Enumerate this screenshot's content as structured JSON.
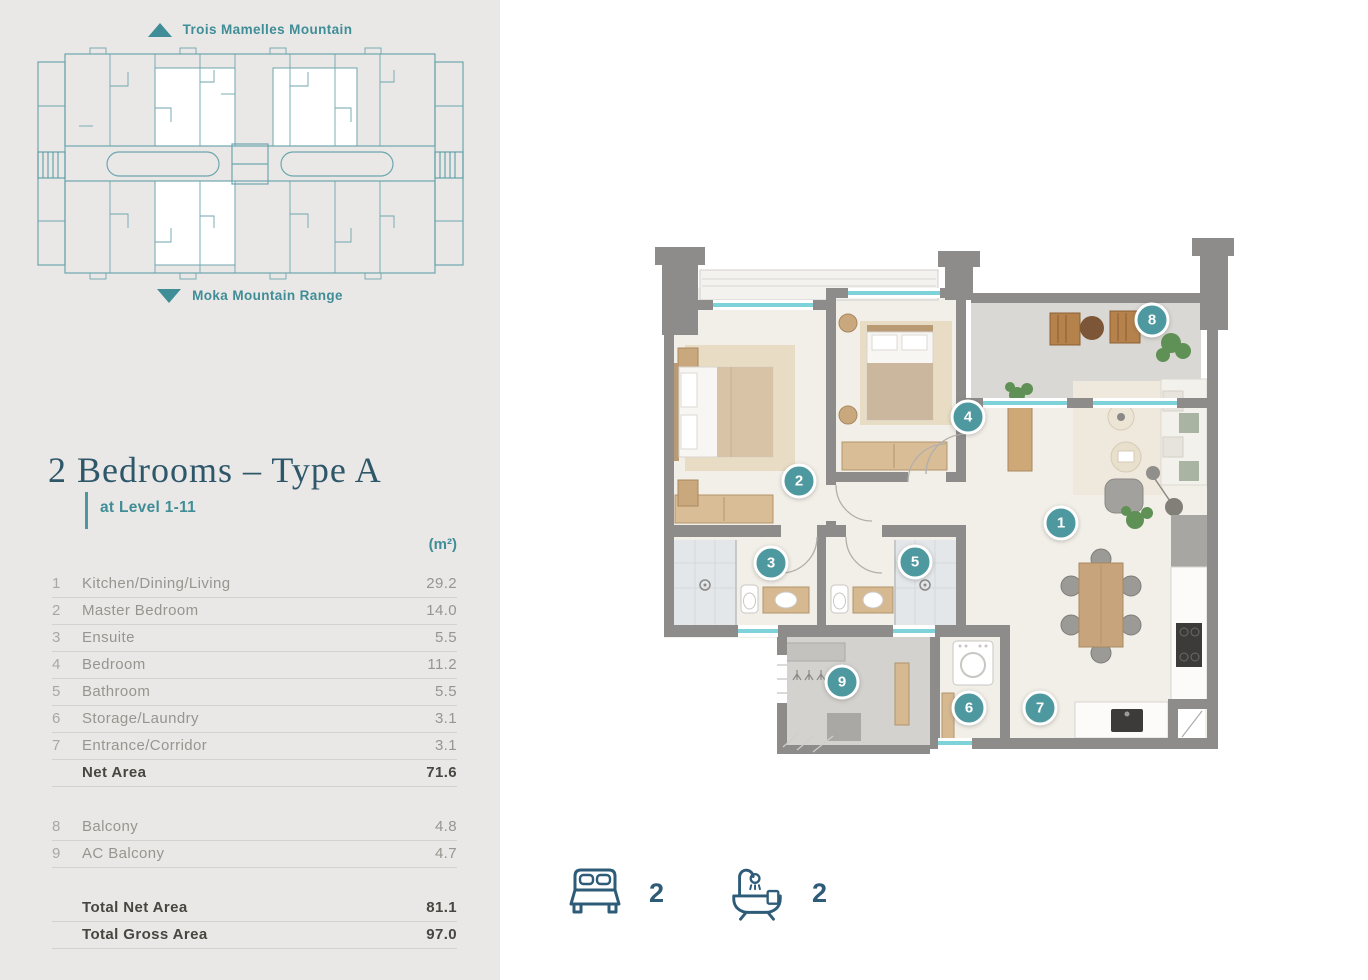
{
  "keyplan": {
    "top_label": "Trois Mamelles Mountain",
    "bottom_label": "Moka Mountain Range"
  },
  "header": {
    "title": "2 Bedrooms – Type A",
    "subtitle": "at Level 1-11",
    "unit_header": "(m²)"
  },
  "area_table": {
    "rows": [
      {
        "num": "1",
        "label": "Kitchen/Dining/Living",
        "value": "29.2"
      },
      {
        "num": "2",
        "label": "Master Bedroom",
        "value": "14.0"
      },
      {
        "num": "3",
        "label": "Ensuite",
        "value": "5.5"
      },
      {
        "num": "4",
        "label": "Bedroom",
        "value": "11.2"
      },
      {
        "num": "5",
        "label": "Bathroom",
        "value": "5.5"
      },
      {
        "num": "6",
        "label": "Storage/Laundry",
        "value": "3.1"
      },
      {
        "num": "7",
        "label": "Entrance/Corridor",
        "value": "3.1"
      }
    ],
    "net_row": {
      "label": "Net Area",
      "value": "71.6"
    },
    "balcony_rows": [
      {
        "num": "8",
        "label": "Balcony",
        "value": "4.8"
      },
      {
        "num": "9",
        "label": "AC Balcony",
        "value": "4.7"
      }
    ],
    "total_rows": [
      {
        "label": "Total Net Area",
        "value": "81.1"
      },
      {
        "label": "Total Gross Area",
        "value": "97.0"
      }
    ]
  },
  "floorplan": {
    "markers": [
      "1",
      "2",
      "3",
      "4",
      "5",
      "6",
      "7",
      "8",
      "9"
    ]
  },
  "summary": {
    "bedrooms": "2",
    "bathrooms": "2"
  },
  "colors": {
    "accent_teal": "#4E98A0",
    "keyplan_teal": "#6EA6AE",
    "title_blue": "#2E576A",
    "icon_navy": "#2D5B78",
    "sidebar_bg": "#E9E8E6",
    "wall_gray": "#8D8C8A",
    "window_teal": "#7ED3DA"
  }
}
